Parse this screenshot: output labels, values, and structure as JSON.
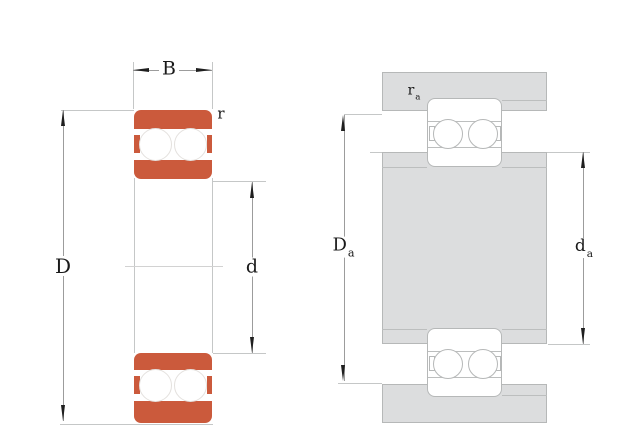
{
  "colors": {
    "background": "#ffffff",
    "bearing_fill": "#cb5a3c",
    "steel_fill": "#dcddde",
    "outline": "#b6b8b8",
    "inner_line": "#bcbebe",
    "dim_line": "#9c9c9c",
    "ext_line": "#c5c7c7",
    "centerline": "#d2d2d2",
    "ball_outline": "#e4e1de",
    "arrow": "#1f1f1f",
    "text": "#1a1a1a"
  },
  "figure_left": {
    "labels": {
      "width": "B",
      "corner_radius": "r",
      "outer_diameter": "D",
      "bore_diameter": "d"
    }
  },
  "figure_right": {
    "labels": {
      "fillet_radius_main": "r",
      "fillet_radius_sub": "a",
      "housing_shoulder_main": "D",
      "housing_shoulder_sub": "a",
      "shaft_shoulder_main": "d",
      "shaft_shoulder_sub": "a"
    }
  }
}
